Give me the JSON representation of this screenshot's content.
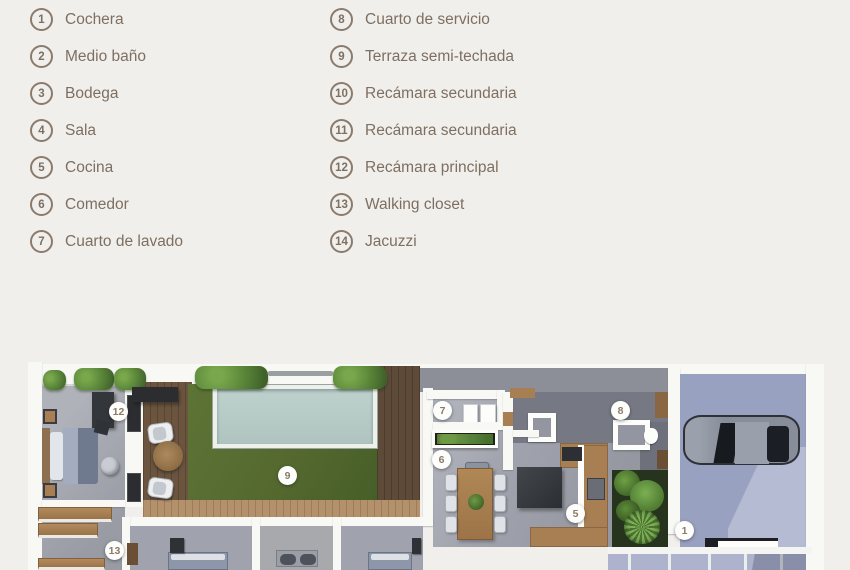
{
  "legend": {
    "left": [
      {
        "number": "1",
        "label": "Cochera"
      },
      {
        "number": "2",
        "label": "Medio baño"
      },
      {
        "number": "3",
        "label": "Bodega"
      },
      {
        "number": "4",
        "label": "Sala"
      },
      {
        "number": "5",
        "label": "Cocina"
      },
      {
        "number": "6",
        "label": "Comedor"
      },
      {
        "number": "7",
        "label": "Cuarto de lavado"
      }
    ],
    "right": [
      {
        "number": "8",
        "label": "Cuarto de servicio"
      },
      {
        "number": "9",
        "label": "Terraza semi-techada"
      },
      {
        "number": "10",
        "label": "Recámara secundaria"
      },
      {
        "number": "11",
        "label": "Recámara secundaria"
      },
      {
        "number": "12",
        "label": "Recámara principal"
      },
      {
        "number": "13",
        "label": "Walking closet"
      },
      {
        "number": "14",
        "label": "Jacuzzi"
      }
    ]
  },
  "plan": {
    "markers": [
      {
        "number": "12"
      },
      {
        "number": "9"
      },
      {
        "number": "7"
      },
      {
        "number": "6"
      },
      {
        "number": "8"
      },
      {
        "number": "5"
      },
      {
        "number": "1"
      },
      {
        "number": "13"
      }
    ],
    "colors": {
      "bg": "#f1efec",
      "accent": "#8b7b6c",
      "ink": "#7d6f61",
      "wall": "#f8f8f5",
      "floor": "#a0a3ad",
      "floorDark": "#767983",
      "lawn": "#55692f",
      "pool": "#b9cdc9",
      "deck": "#6b5540",
      "deckLight": "#b3916c",
      "wood": "#a87f53",
      "furnDark": "#33363b",
      "garage": "#99a1c0",
      "driveway": "#adb3cc",
      "car": "#878d99",
      "hedge": "#5f8c3c",
      "soil": "#26331d",
      "markerInk": "#8a7a68"
    }
  }
}
